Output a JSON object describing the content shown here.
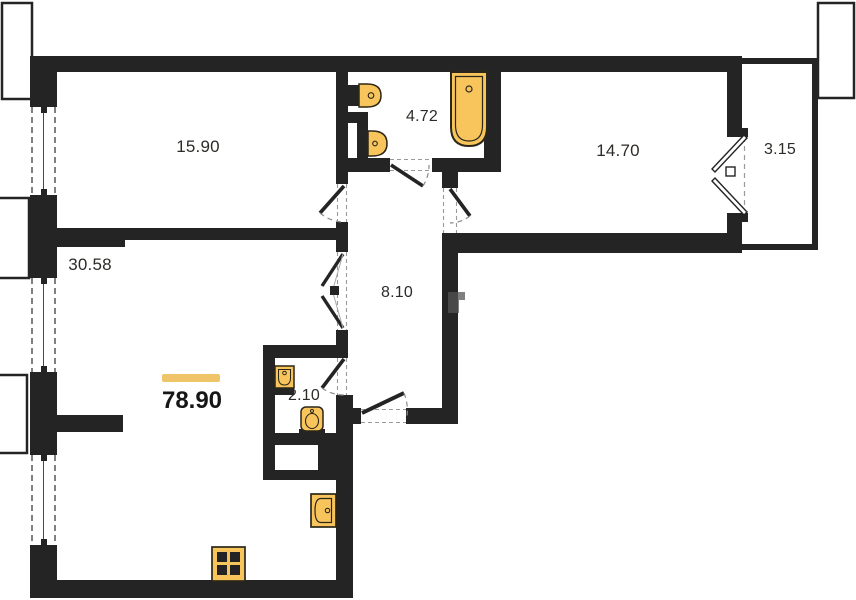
{
  "plan_title": "apartment-floor-plan",
  "total_area": "78.90",
  "rooms": [
    {
      "name": "bedroom",
      "area": "15.90"
    },
    {
      "name": "bathroom",
      "area": "4.72"
    },
    {
      "name": "bedroom-2",
      "area": "14.70"
    },
    {
      "name": "balcony",
      "area": "3.15"
    },
    {
      "name": "living-kitchen",
      "area": "30.58"
    },
    {
      "name": "hallway",
      "area": "8.10"
    },
    {
      "name": "wc",
      "area": "2.10"
    }
  ],
  "fixtures": [
    "bathtub-icon",
    "toilet-icon",
    "sink-icon",
    "wc-sink-icon",
    "wc-toilet-icon",
    "kitchen-sink-icon",
    "stove-icon"
  ],
  "colors": {
    "wall": "#242424",
    "fixture_fill": "#F8C55D",
    "fixture_border": "#2b2617",
    "accent_bar": "#F0C56A",
    "label_text": "#2d2b28"
  }
}
